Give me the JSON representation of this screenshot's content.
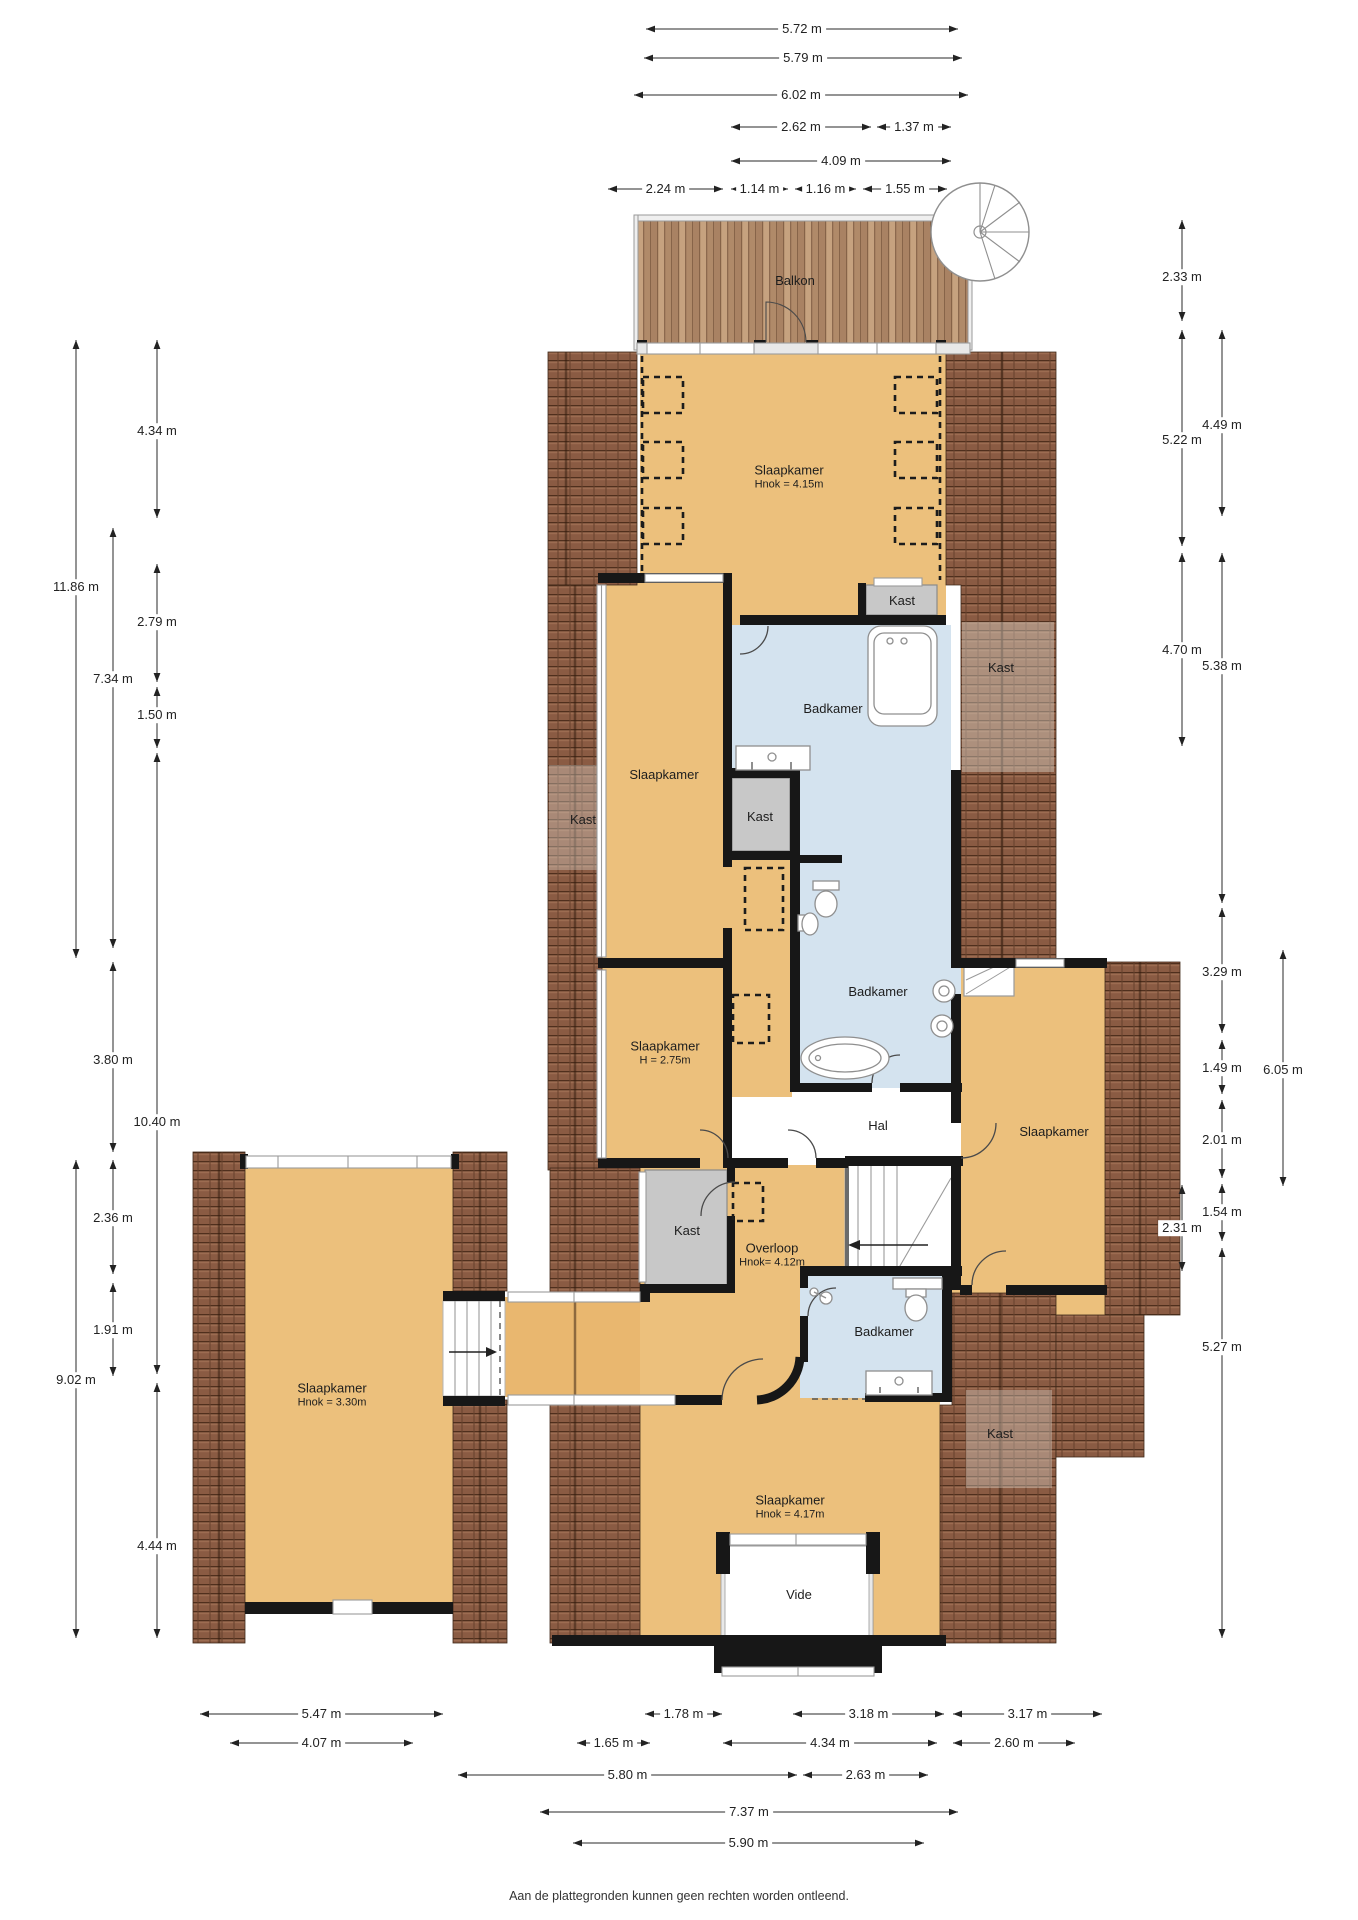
{
  "footer": "Aan de plattegronden kunnen geen rechten worden ontleend.",
  "colors": {
    "floor": "#ecc07c",
    "corridor_floor": "#e9b76f",
    "bathroom": "#d4e3ef",
    "closet_gray": "#c8c8c8",
    "roof": "#8a5b43",
    "wall": "#171717",
    "deck_wood": "#bd9a78"
  },
  "rooms": [
    {
      "name": "Balkon",
      "x": 795,
      "y": 281
    },
    {
      "name": "Slaapkamer",
      "sub": "Hnok = 4.15m",
      "x": 789,
      "y": 477
    },
    {
      "name": "Kast",
      "x": 902,
      "y": 601
    },
    {
      "name": "Kast",
      "x": 1001,
      "y": 668
    },
    {
      "name": "Badkamer",
      "x": 833,
      "y": 709
    },
    {
      "name": "Kast",
      "x": 583,
      "y": 820
    },
    {
      "name": "Slaapkamer",
      "x": 664,
      "y": 775
    },
    {
      "name": "Kast",
      "x": 760,
      "y": 817
    },
    {
      "name": "Badkamer",
      "x": 878,
      "y": 992
    },
    {
      "name": "Slaapkamer",
      "sub": "H = 2.75m",
      "x": 665,
      "y": 1053
    },
    {
      "name": "Hal",
      "x": 878,
      "y": 1126
    },
    {
      "name": "Slaapkamer",
      "x": 1054,
      "y": 1132
    },
    {
      "name": "Kast",
      "x": 687,
      "y": 1231
    },
    {
      "name": "Overloop",
      "sub": "Hnok= 4.12m",
      "x": 772,
      "y": 1255
    },
    {
      "name": "Badkamer",
      "x": 884,
      "y": 1332
    },
    {
      "name": "Slaapkamer",
      "sub": "Hnok = 3.30m",
      "x": 332,
      "y": 1395
    },
    {
      "name": "Kast",
      "x": 1000,
      "y": 1434
    },
    {
      "name": "Slaapkamer",
      "sub": "Hnok = 4.17m",
      "x": 790,
      "y": 1507
    },
    {
      "name": "Vide",
      "x": 799,
      "y": 1595
    }
  ],
  "dims_horizontal": [
    {
      "label": "5.72 m",
      "y": 29,
      "x1": 646,
      "x2": 958
    },
    {
      "label": "5.79 m",
      "y": 58,
      "x1": 644,
      "x2": 962
    },
    {
      "label": "6.02 m",
      "y": 95,
      "x1": 634,
      "x2": 968
    },
    {
      "label": "2.62 m",
      "y": 127,
      "x1": 731,
      "x2": 871
    },
    {
      "label": "1.37 m",
      "y": 127,
      "x1": 877,
      "x2": 951
    },
    {
      "label": "4.09 m",
      "y": 161,
      "x1": 731,
      "x2": 951
    },
    {
      "label": "2.24 m",
      "y": 189,
      "x1": 608,
      "x2": 723
    },
    {
      "label": "1.14 m",
      "y": 189,
      "x1": 731,
      "x2": 788
    },
    {
      "label": "1.16 m",
      "y": 189,
      "x1": 795,
      "x2": 856
    },
    {
      "label": "1.55 m",
      "y": 189,
      "x1": 863,
      "x2": 947
    },
    {
      "label": "5.47 m",
      "y": 1714,
      "x1": 200,
      "x2": 443
    },
    {
      "label": "1.78 m",
      "y": 1714,
      "x1": 645,
      "x2": 722
    },
    {
      "label": "3.18 m",
      "y": 1714,
      "x1": 793,
      "x2": 944
    },
    {
      "label": "3.17 m",
      "y": 1714,
      "x1": 953,
      "x2": 1102
    },
    {
      "label": "4.07 m",
      "y": 1743,
      "x1": 230,
      "x2": 413
    },
    {
      "label": "1.65 m",
      "y": 1743,
      "x1": 577,
      "x2": 650
    },
    {
      "label": "4.34 m",
      "y": 1743,
      "x1": 723,
      "x2": 937
    },
    {
      "label": "2.60 m",
      "y": 1743,
      "x1": 953,
      "x2": 1075
    },
    {
      "label": "5.80 m",
      "y": 1775,
      "x1": 458,
      "x2": 797
    },
    {
      "label": "2.63 m",
      "y": 1775,
      "x1": 803,
      "x2": 928
    },
    {
      "label": "7.37 m",
      "y": 1812,
      "x1": 540,
      "x2": 958
    },
    {
      "label": "5.90 m",
      "y": 1843,
      "x1": 573,
      "x2": 924
    }
  ],
  "dims_vertical": [
    {
      "label": "11.86 m",
      "x": 76,
      "y1": 340,
      "y2": 958,
      "ly": 587
    },
    {
      "label": "9.02 m",
      "x": 76,
      "y1": 1160,
      "y2": 1638,
      "ly": 1380
    },
    {
      "label": "7.34 m",
      "x": 113,
      "y1": 528,
      "y2": 948,
      "ly": 679
    },
    {
      "label": "3.80 m",
      "x": 113,
      "y1": 962,
      "y2": 1152,
      "ly": 1060
    },
    {
      "label": "2.36 m",
      "x": 113,
      "y1": 1160,
      "y2": 1274,
      "ly": 1218
    },
    {
      "label": "1.91 m",
      "x": 113,
      "y1": 1283,
      "y2": 1376,
      "ly": 1330
    },
    {
      "label": "4.34 m",
      "x": 157,
      "y1": 340,
      "y2": 518,
      "ly": 431
    },
    {
      "label": "2.79 m",
      "x": 157,
      "y1": 564,
      "y2": 682,
      "ly": 622
    },
    {
      "label": "1.50 m",
      "x": 157,
      "y1": 687,
      "y2": 748,
      "ly": 715
    },
    {
      "label": "10.40 m",
      "x": 157,
      "y1": 753,
      "y2": 1374,
      "ly": 1122
    },
    {
      "label": "4.44 m",
      "x": 157,
      "y1": 1383,
      "y2": 1638,
      "ly": 1546
    },
    {
      "label": "2.33 m",
      "x": 1182,
      "y1": 220,
      "y2": 321,
      "ly": 277
    },
    {
      "label": "5.22 m",
      "x": 1182,
      "y1": 330,
      "y2": 546,
      "ly": 440
    },
    {
      "label": "4.70 m",
      "x": 1182,
      "y1": 553,
      "y2": 746,
      "ly": 650
    },
    {
      "label": "2.31 m",
      "x": 1182,
      "y1": 1185,
      "y2": 1271,
      "ly": 1228
    },
    {
      "label": "4.49 m",
      "x": 1222,
      "y1": 330,
      "y2": 516,
      "ly": 425
    },
    {
      "label": "5.38 m",
      "x": 1222,
      "y1": 553,
      "y2": 903,
      "ly": 666
    },
    {
      "label": "3.29 m",
      "x": 1222,
      "y1": 908,
      "y2": 1033,
      "ly": 972
    },
    {
      "label": "1.49 m",
      "x": 1222,
      "y1": 1040,
      "y2": 1094,
      "ly": 1068
    },
    {
      "label": "2.01 m",
      "x": 1222,
      "y1": 1100,
      "y2": 1178,
      "ly": 1140
    },
    {
      "label": "1.54 m",
      "x": 1222,
      "y1": 1184,
      "y2": 1241,
      "ly": 1212
    },
    {
      "label": "5.27 m",
      "x": 1222,
      "y1": 1248,
      "y2": 1638,
      "ly": 1347
    },
    {
      "label": "6.05 m",
      "x": 1283,
      "y1": 950,
      "y2": 1186,
      "ly": 1070
    }
  ]
}
